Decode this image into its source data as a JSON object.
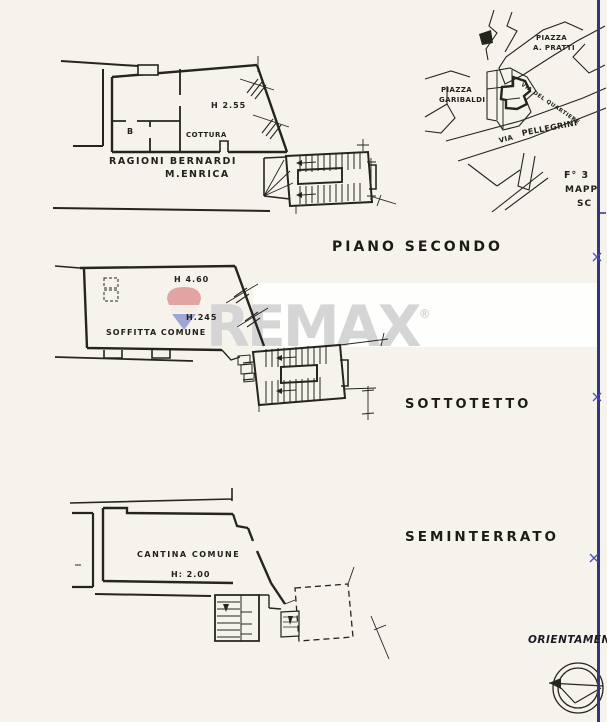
{
  "scan": {
    "background_color": "#f6f3ec",
    "ink_color": "#26241f",
    "edge_line_color": "#35357e"
  },
  "plans": {
    "piano_secondo": {
      "title": "PIANO SECONDO",
      "labels": {
        "height_main": "H 2.55",
        "room_b": "B",
        "kitchen": "COTTURA",
        "owner_line1": "RAGIONI BERNARDI",
        "owner_line2": "M.ENRICA"
      }
    },
    "sottotetto": {
      "title": "SOTTOTETTO",
      "labels": {
        "height_ridge": "H 4.60",
        "height_mid": "H.245",
        "room": "SOFFITTA COMUNE"
      }
    },
    "seminterrato": {
      "title": "SEMINTERRATO",
      "labels": {
        "room": "CANTINA COMUNE",
        "height": "H: 2.00"
      }
    }
  },
  "map": {
    "labels": {
      "piazza_pratti_line1": "PIAZZA",
      "piazza_pratti_line2": "A. PRATTI",
      "piazza_garibaldi_line1": "PIAZZA",
      "piazza_garibaldi_line2": "GARIBALDI",
      "via_pellegrini_via": "VIA",
      "via_pellegrini_name": "PELLEGRINI",
      "via_quartiere": "VIA DEL QUARTIERE"
    },
    "sheet_ref": {
      "line1": "F° 3",
      "line2": "MAPP",
      "line3": "SC"
    }
  },
  "watermark": {
    "brand": "REMAX",
    "reg_mark": "®",
    "text_color": "#d5d5d6",
    "balloon_red": "#dc9191",
    "balloon_blue": "#8a93cb"
  },
  "orientation": {
    "label": "ORIENTAMEN"
  }
}
